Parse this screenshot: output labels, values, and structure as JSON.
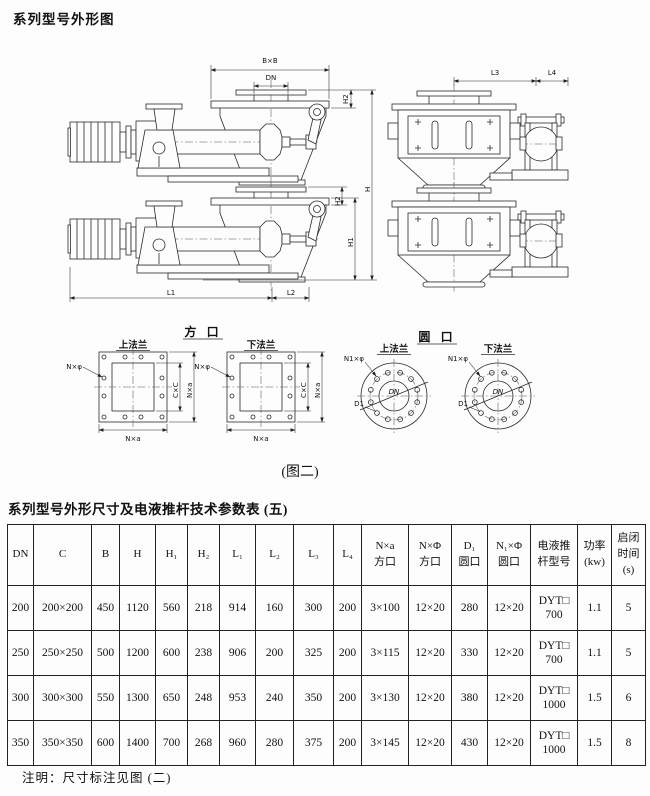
{
  "page": {
    "title": "系列型号外形图",
    "figure_caption": "(图二)",
    "table_title": "系列型号外形尺寸及电液推杆技术参数表 (五)",
    "footnote": "注明：尺寸标注见图 (二)"
  },
  "drawing": {
    "dim_bxb": "B×B",
    "dim_dn": "DN",
    "dim_h": "H",
    "dim_h1": "H1",
    "dim_h2": "H2",
    "dim_l1": "L1",
    "dim_l2": "L2",
    "dim_l3": "L3",
    "dim_l4": "L4",
    "square_port_title": "方 口",
    "round_port_title": "圆 口",
    "upper_flange_label": "上法兰",
    "lower_flange_label": "下法兰",
    "bolt_label_square": "N×φ",
    "inner_dim_square": "C×C",
    "outer_dim_square": "N×a",
    "bolt_label_round": "N1×φ",
    "bolt_circle_dia": "D1",
    "bore_label": "DN"
  },
  "table": {
    "headers": [
      "DN",
      "C",
      "B",
      "H",
      "H₁",
      "H₂",
      "L₁",
      "L₂",
      "L₃",
      "L₄",
      "N×a\n方口",
      "N×Φ\n方口",
      "D₁\n圆口",
      "N₁×Φ\n圆口",
      "电液推\n杆型号",
      "功率\n(kw)",
      "启闭\n时间\n(s)"
    ],
    "rows": [
      [
        "200",
        "200×200",
        "450",
        "1120",
        "560",
        "218",
        "914",
        "160",
        "300",
        "200",
        "3×100",
        "12×20",
        "280",
        "12×20",
        "DYT□\n700",
        "1.1",
        "5"
      ],
      [
        "250",
        "250×250",
        "500",
        "1200",
        "600",
        "238",
        "906",
        "200",
        "325",
        "200",
        "3×115",
        "12×20",
        "330",
        "12×20",
        "DYT□\n700",
        "1.1",
        "5"
      ],
      [
        "300",
        "300×300",
        "550",
        "1300",
        "650",
        "248",
        "953",
        "240",
        "350",
        "200",
        "3×130",
        "12×20",
        "380",
        "12×20",
        "DYT□\n1000",
        "1.5",
        "6"
      ],
      [
        "350",
        "350×350",
        "600",
        "1400",
        "700",
        "268",
        "960",
        "280",
        "375",
        "200",
        "3×145",
        "12×20",
        "430",
        "12×20",
        "DYT□\n1000",
        "1.5",
        "8"
      ]
    ]
  }
}
